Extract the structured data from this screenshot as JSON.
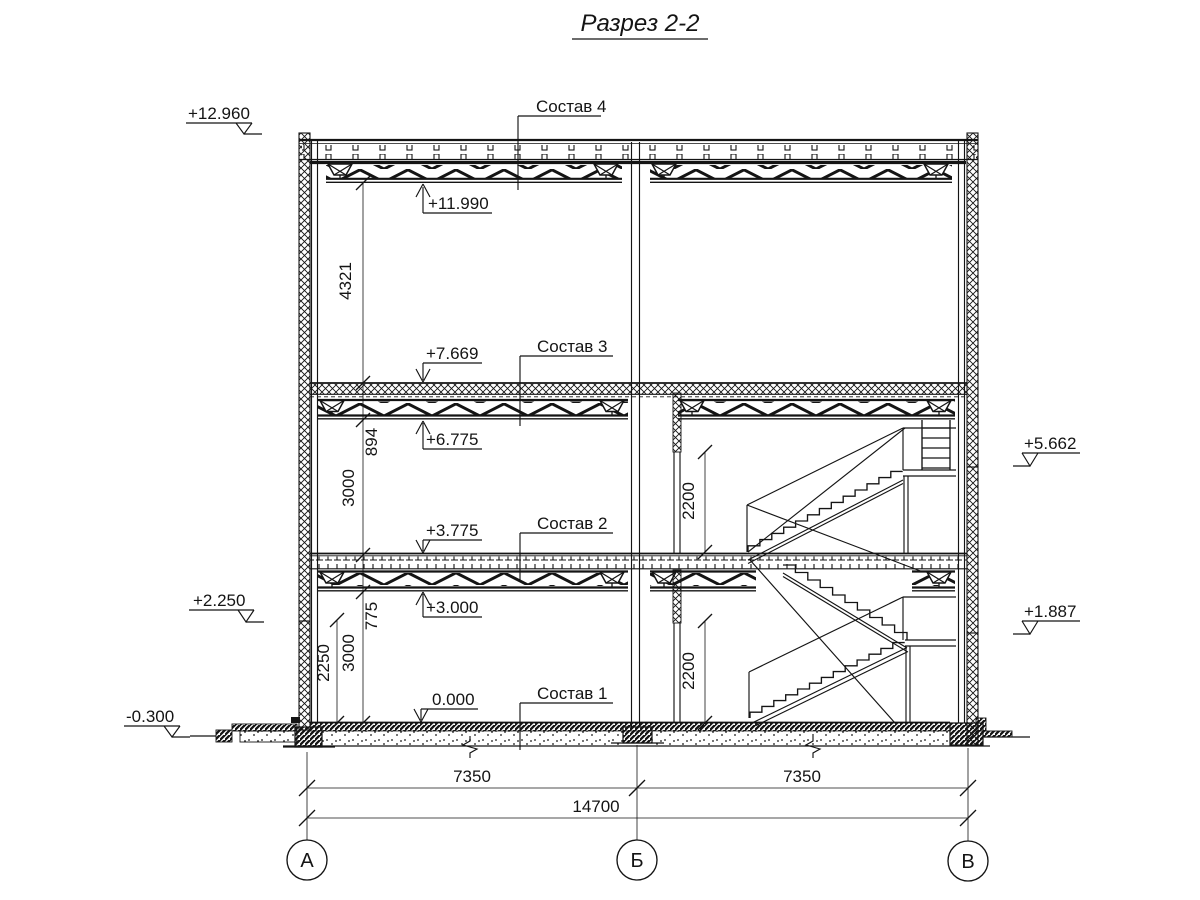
{
  "title": "Разрез 2-2",
  "layers": {
    "l4": "Состав 4",
    "l3": "Состав 3",
    "l2": "Состав 2",
    "l1": "Состав 1"
  },
  "elevations": {
    "e12960": "+12.960",
    "e11990": "+11.990",
    "e7669": "+7.669",
    "e6775": "+6.775",
    "e5662": "+5.662",
    "e3775": "+3.775",
    "e3000": "+3.000",
    "e2250": "+2.250",
    "e1887": "+1.887",
    "e0": "0.000",
    "em300": "-0.300"
  },
  "dims": {
    "v4321": "4321",
    "v894": "894",
    "v3000a": "3000",
    "v775": "775",
    "v3000b": "3000",
    "v2250": "2250",
    "v2200a": "2200",
    "v2200b": "2200",
    "h7350a": "7350",
    "h7350b": "7350",
    "h14700": "14700"
  },
  "axes": {
    "a": "А",
    "b": "Б",
    "v": "В"
  },
  "colors": {
    "ink": "#141414",
    "paper": "#ffffff"
  }
}
